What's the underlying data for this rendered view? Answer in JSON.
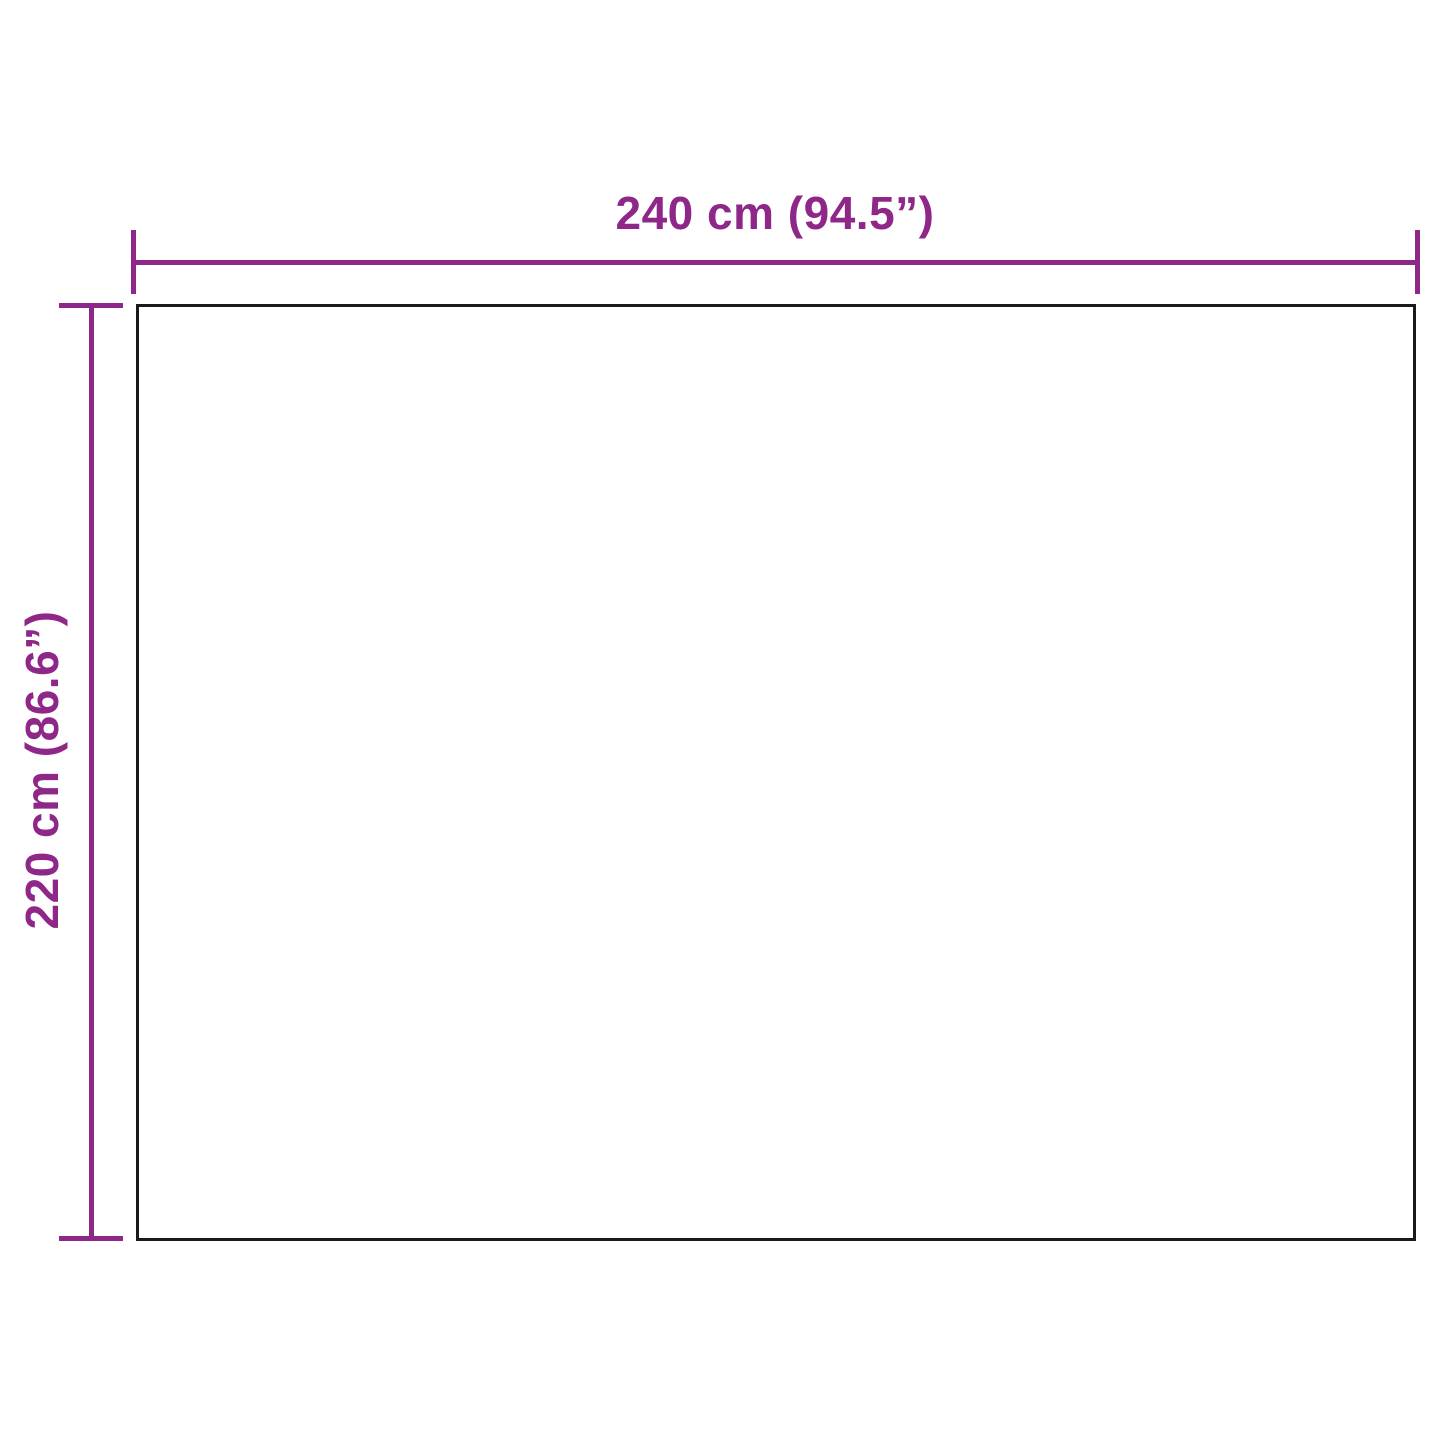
{
  "diagram": {
    "type": "product-dimension-diagram",
    "width_label": "240 cm (94.5”)",
    "height_label": "220 cm (86.6”)",
    "width_value_cm": 240,
    "width_value_inches": 94.5,
    "height_value_cm": 220,
    "height_value_inches": 86.6
  },
  "colors": {
    "accent": "#8e2788",
    "outline": "#1a1a1a",
    "background": "#ffffff"
  }
}
